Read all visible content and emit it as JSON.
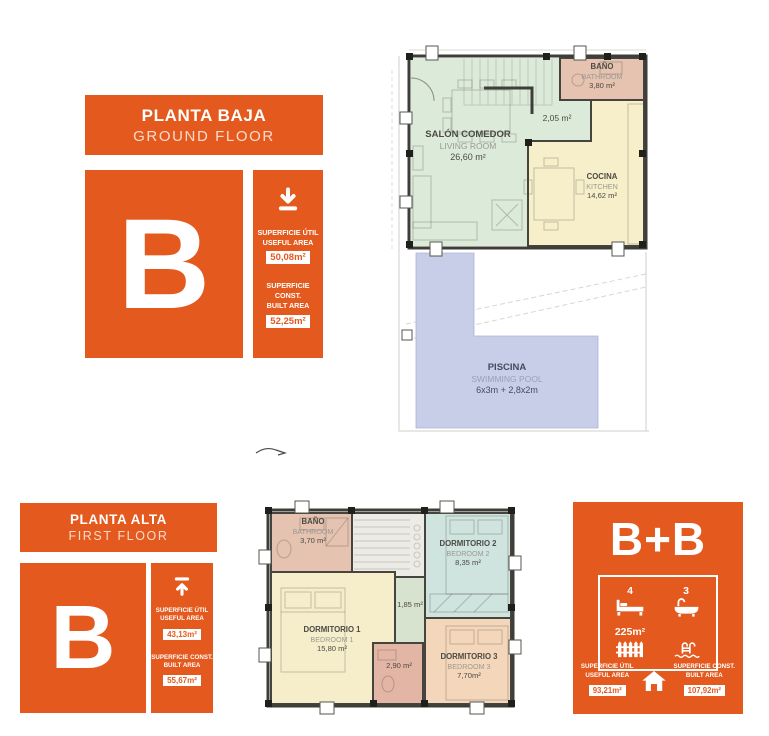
{
  "palette": {
    "accent": "#e45a1e",
    "wall": "#3e3d38",
    "living_green": "#dcead9",
    "kitchen_yellow": "#f6efca",
    "bathroom_pink": "#e6c2b0",
    "pool_blue": "#c9cee8",
    "bedroom1_yellow": "#f6eecb",
    "bedroom2_teal": "#cfe3df",
    "bedroom3_peach": "#f4d6ba",
    "hall_green": "#d8e3cf",
    "stairs_grey": "#edebe5"
  },
  "ground_floor": {
    "header": {
      "title": "PLANTA BAJA",
      "subtitle": "GROUND FLOOR"
    },
    "letter": "B",
    "stats": {
      "useful": {
        "line1": "SUPERFICIE ÚTIL",
        "line2": "USEFUL AREA",
        "value": "50,08m²"
      },
      "built": {
        "line1": "SUPERFICIE CONST.",
        "line2": "BUILT AREA",
        "value": "52,25m²"
      }
    },
    "plan": {
      "salon": {
        "name": "SALÓN COMEDOR",
        "name_en": "LIVING ROOM",
        "area": "26,60 m²"
      },
      "bano": {
        "name": "BAÑO",
        "name_en": "BATHROOM",
        "area": "3,80 m²"
      },
      "cocina": {
        "name": "COCINA",
        "name_en": "KITCHEN",
        "area": "14,62 m²"
      },
      "hall": {
        "area": "2,05 m²"
      },
      "piscina": {
        "name": "PISCINA",
        "name_en": "SWIMMING POOL",
        "area": "6x3m + 2,8x2m"
      }
    }
  },
  "first_floor": {
    "header": {
      "title": "PLANTA ALTA",
      "subtitle": "FIRST FLOOR"
    },
    "letter": "B",
    "stats": {
      "useful": {
        "line1": "SUPERFICIE ÚTIL",
        "line2": "USEFUL AREA",
        "value": "43,13m²"
      },
      "built": {
        "line1": "SUPERFICIE CONST.",
        "line2": "BUILT AREA",
        "value": "55,67m²"
      }
    },
    "plan": {
      "bano": {
        "name": "BAÑO",
        "name_en": "BATHROOM",
        "area": "3,70 m²"
      },
      "dormitorio2": {
        "name": "DORMITORIO 2",
        "name_en": "BEDROOM 2",
        "area": "8,35 m²"
      },
      "hall": {
        "area": "1,85 m²"
      },
      "dormitorio1": {
        "name": "DORMITORIO 1",
        "name_en": "BEDROOM 1",
        "area": "15,80 m²"
      },
      "bano2": {
        "area": "2,90 m²"
      },
      "dormitorio3": {
        "name": "DORMITORIO 3",
        "name_en": "BEDROOM 3",
        "area": "7,70m²"
      }
    }
  },
  "summary": {
    "title": "B+B",
    "bedrooms": "4",
    "bathrooms": "3",
    "plot_area": "225m²",
    "stats": {
      "useful": {
        "line1": "SUPERFICIE ÚTIL",
        "line2": "USEFUL AREA",
        "value": "93,21m²"
      },
      "built": {
        "line1": "SUPERFICIE CONST.",
        "line2": "BUILT AREA",
        "value": "107,92m²"
      }
    }
  }
}
